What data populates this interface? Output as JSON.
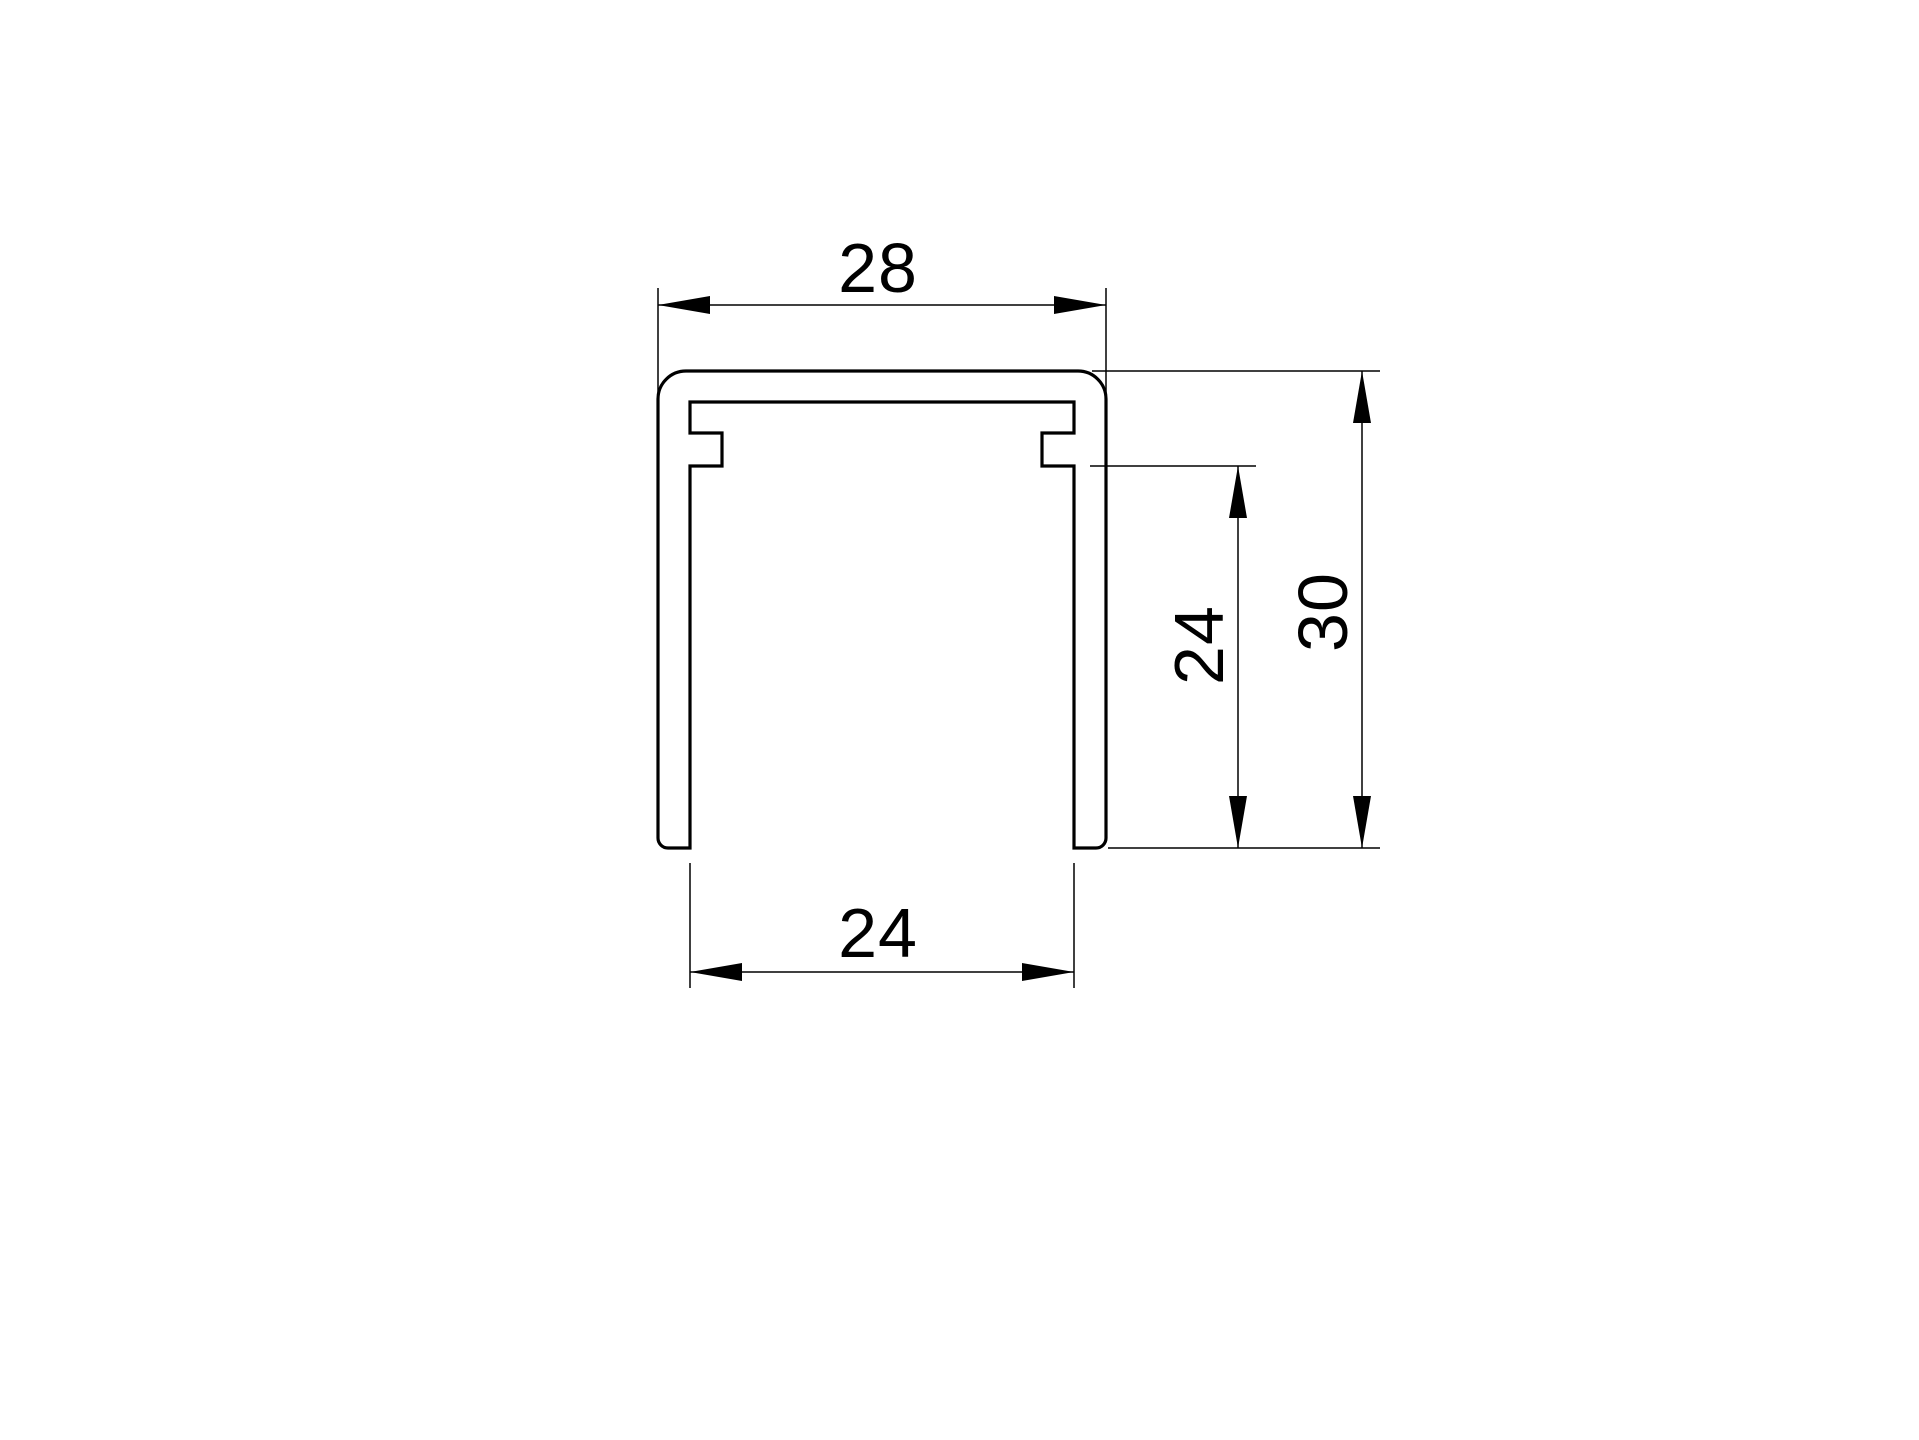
{
  "page": {
    "background_color": "#ffffff"
  },
  "drawing": {
    "stroke_color": "#000000",
    "part": "u-channel-profile-cross-section",
    "labels": {
      "outer_width": "28",
      "inner_width": "24",
      "inner_height": "24",
      "outer_height": "30"
    }
  }
}
